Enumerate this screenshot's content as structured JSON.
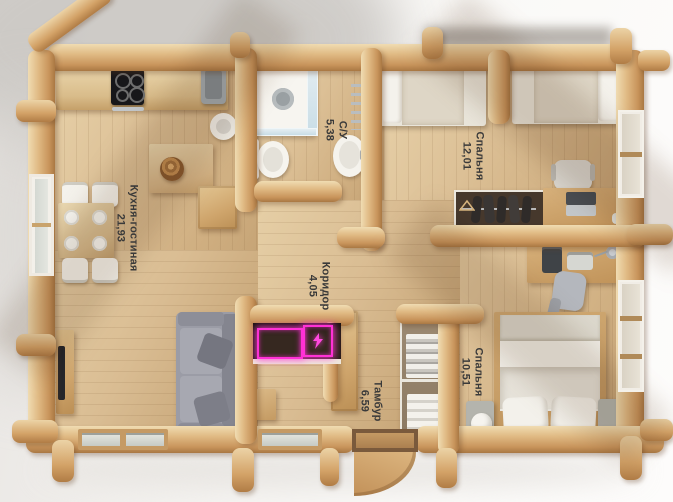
{
  "scene": {
    "type": "3d-floor-plan-top-view",
    "style": "log-cabin-house"
  },
  "rooms": [
    {
      "id": "kitchen-living-room",
      "name": "Кухня-гостиная",
      "area": "21,93"
    },
    {
      "id": "bathroom",
      "name": "С/У",
      "area": "5,38"
    },
    {
      "id": "bedroom-1",
      "name": "Спальня",
      "area": "12,01"
    },
    {
      "id": "corridor",
      "name": "Коридор",
      "area": "4,05"
    },
    {
      "id": "vestibule",
      "name": "Тамбур",
      "area": "6,59"
    },
    {
      "id": "bedroom-2",
      "name": "Спальня",
      "area": "10,51"
    }
  ],
  "icons": {
    "electric_panel": "lightning-icon"
  },
  "colors": {
    "log_wood": "#d9ae77",
    "floor_wood": "#d8bd94",
    "glow_accent": "#ff31d6",
    "sofa_gray": "#9b9ca6",
    "linen_white": "#eae7df",
    "label_text": "#3a3a3a"
  }
}
